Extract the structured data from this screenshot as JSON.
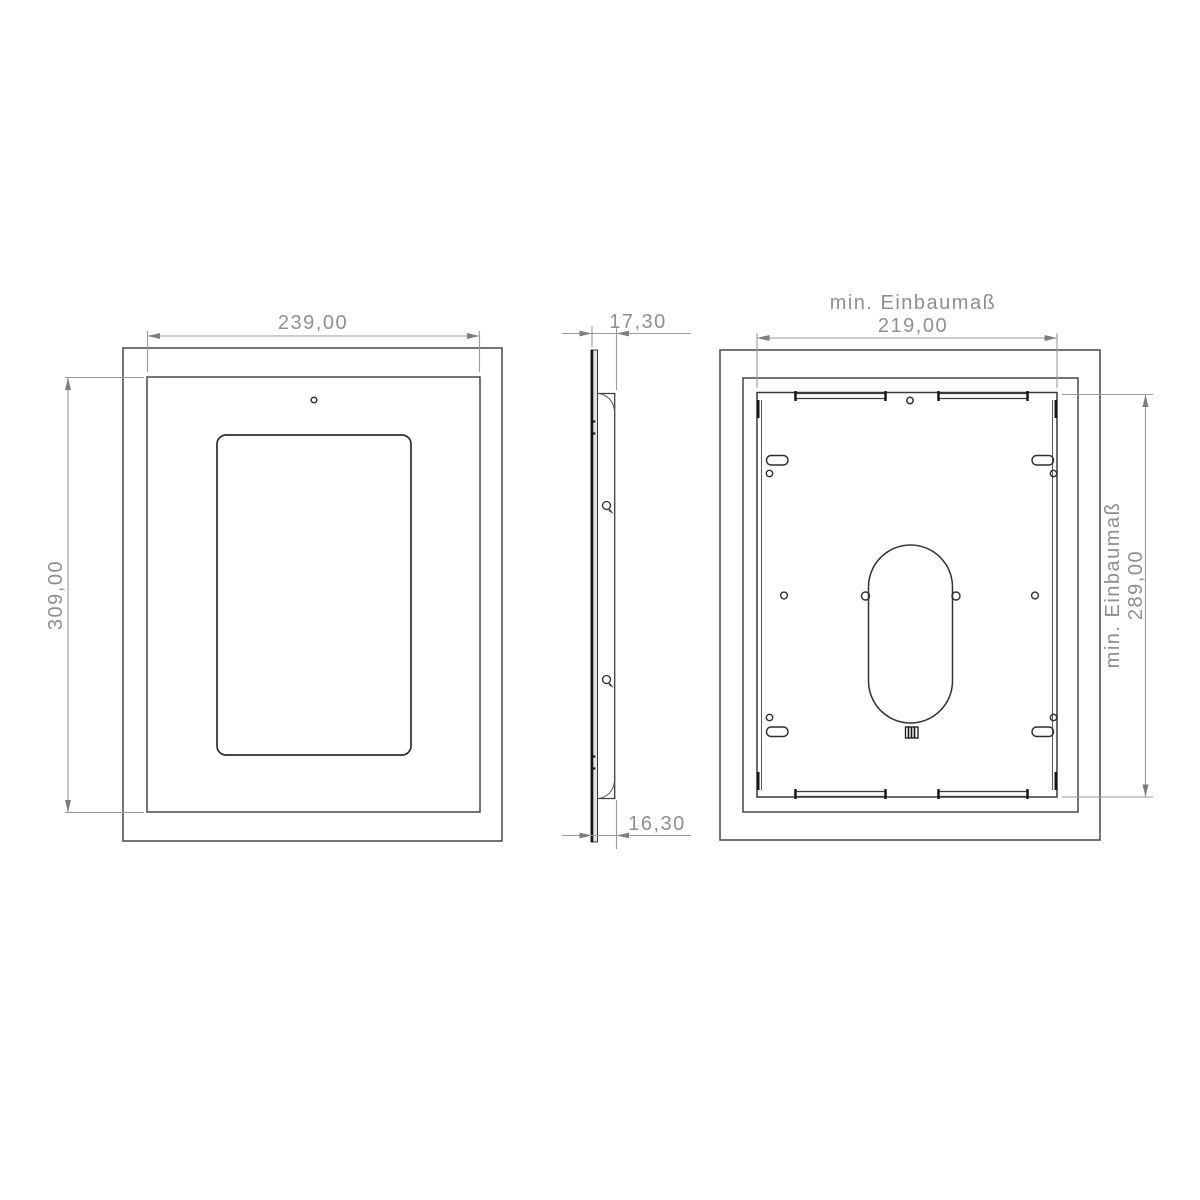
{
  "drawing": {
    "type": "technical-drawing-tablet-wall-mount",
    "views": {
      "front": {
        "width_dim": "239,00",
        "height_dim": "309,00"
      },
      "side": {
        "top_dim": "17,30",
        "bottom_dim": "16,30"
      },
      "back": {
        "width_dim_title": "min. Einbaumaß",
        "width_dim": "219,00",
        "height_dim_title": "min. Einbaumaß",
        "height_dim": "289,00"
      }
    },
    "colors": {
      "part_line": "#474747",
      "part_dark_line": "#1a1a1a",
      "dimension_line": "#9a9a9a",
      "dimension_text": "#8f8f8f",
      "background": "#ffffff"
    }
  }
}
